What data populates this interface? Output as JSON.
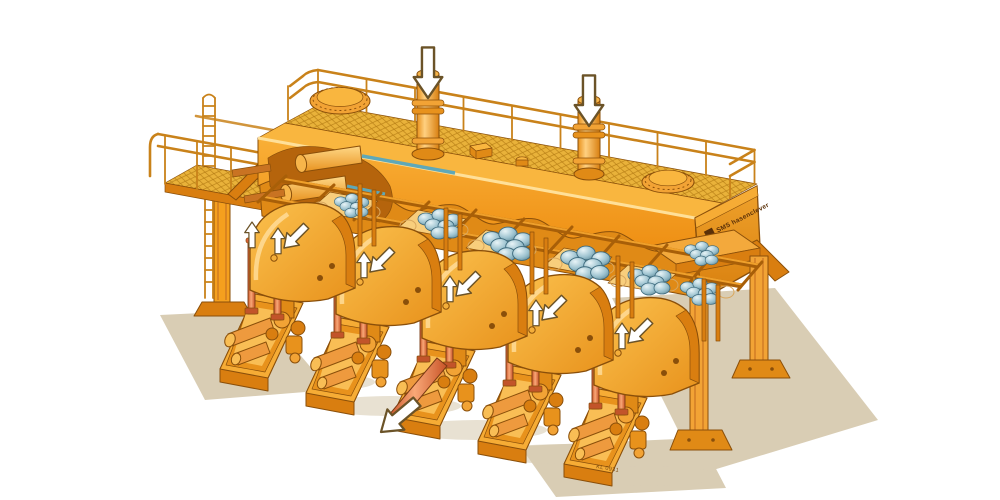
{
  "figure": {
    "type": "technical-illustration",
    "subject": "Five-station forging press with billet transfer rack, cutaway isometric view",
    "background": "#FFFFFF"
  },
  "labels": {
    "manufacturer_logo": "SMS hasenclever",
    "drawing_number": "KL 0931"
  },
  "colors": {
    "machine_orange": "#F5A01E",
    "machine_orange_light": "#F9B63F",
    "machine_orange_pale": "#FBC96B",
    "machine_orange_dark": "#D97E10",
    "machine_orange_deep": "#B5640C",
    "outline_brown": "#8A4F0A",
    "railing_orange": "#C9821A",
    "mesh_gold": "#E9B23A",
    "mesh_line": "#B87F15",
    "tray_cream": "#F8CE7C",
    "billet_blue": "#9CC2CF",
    "billet_blue_dark": "#5C8A9C",
    "candle_salmon": "#E88456",
    "candle_dark": "#C2542A",
    "shadow_tan": "#D9CDB4",
    "arrow_white": "#FFFFFF",
    "arrow_outline": "#6B5328",
    "background": "#FFFFFF"
  },
  "machine": {
    "stations": 5,
    "billet_groups": 7,
    "top_press_cylinders": 2,
    "manhole_covers": 2,
    "ejector_rods_per_station": 2,
    "arrows": {
      "top_press_down": 2,
      "station_flow_down_left": 5,
      "ejector_up": 10,
      "extraction_down_left": 1
    }
  }
}
